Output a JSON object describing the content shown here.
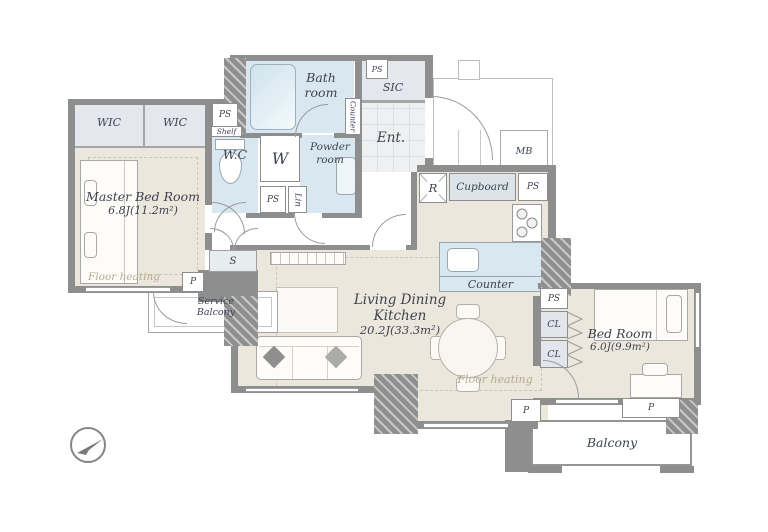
{
  "rooms": {
    "master": {
      "name": "Master Bed Room",
      "size": "6.8J(11.2m²)"
    },
    "ldk": {
      "line1": "Living Dining",
      "line2": "Kitchen",
      "size": "20.2J(33.3m²)"
    },
    "bedroom": {
      "name": "Bed Room",
      "size": "6.0J(9.9m²)"
    },
    "bath": {
      "line1": "Bath",
      "line2": "room"
    },
    "powder": {
      "line1": "Powder",
      "line2": "room"
    },
    "wc": {
      "name": "W.C"
    },
    "ent": {
      "name": "Ent."
    },
    "sic": {
      "name": "SIC"
    },
    "balcony": {
      "name": "Balcony"
    },
    "service_balcony": {
      "line1": "Service",
      "line2": "Balcony"
    }
  },
  "labels": {
    "wic": "WIC",
    "ps": "PS",
    "shelf": "Shelf",
    "washer": "W",
    "lin": "Lin",
    "counter": "Counter",
    "cupboard": "Cupboard",
    "refrigerator": "R",
    "mb": "MB",
    "storage": "S",
    "p": "P",
    "cl": "CL",
    "floor_heating": "Floor heating"
  },
  "colors": {
    "wall": "#8e8e8e",
    "room_floor": "#ece7dc",
    "wet_floor": "#d9e8f0",
    "closet_floor": "#e4e7ed",
    "text": "#3d4350",
    "floor_heating_text": "#b5ac92"
  }
}
